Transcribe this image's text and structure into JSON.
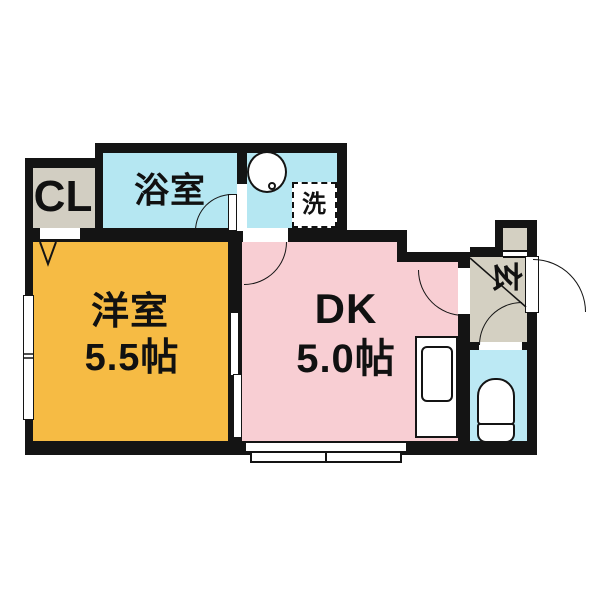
{
  "title": "1DK apartment floor plan",
  "colors": {
    "bg": "#ffffff",
    "wall": "#141414",
    "line": "#141414",
    "bath": "#b5e7f2",
    "toilet": "#bce9f4",
    "western": "#f6bb44",
    "dk": "#f8ced3",
    "closet": "#d2cec2",
    "genkan": "#d4d0c2"
  },
  "rooms": {
    "closet": {
      "label": "CL"
    },
    "bath": {
      "label": "浴室"
    },
    "washroom": {
      "washer_label": "洗"
    },
    "western": {
      "name": "洋室",
      "size": "5.5帖"
    },
    "dk": {
      "name": "DK",
      "size": "5.0帖"
    },
    "genkan": {
      "label": "玄"
    }
  }
}
